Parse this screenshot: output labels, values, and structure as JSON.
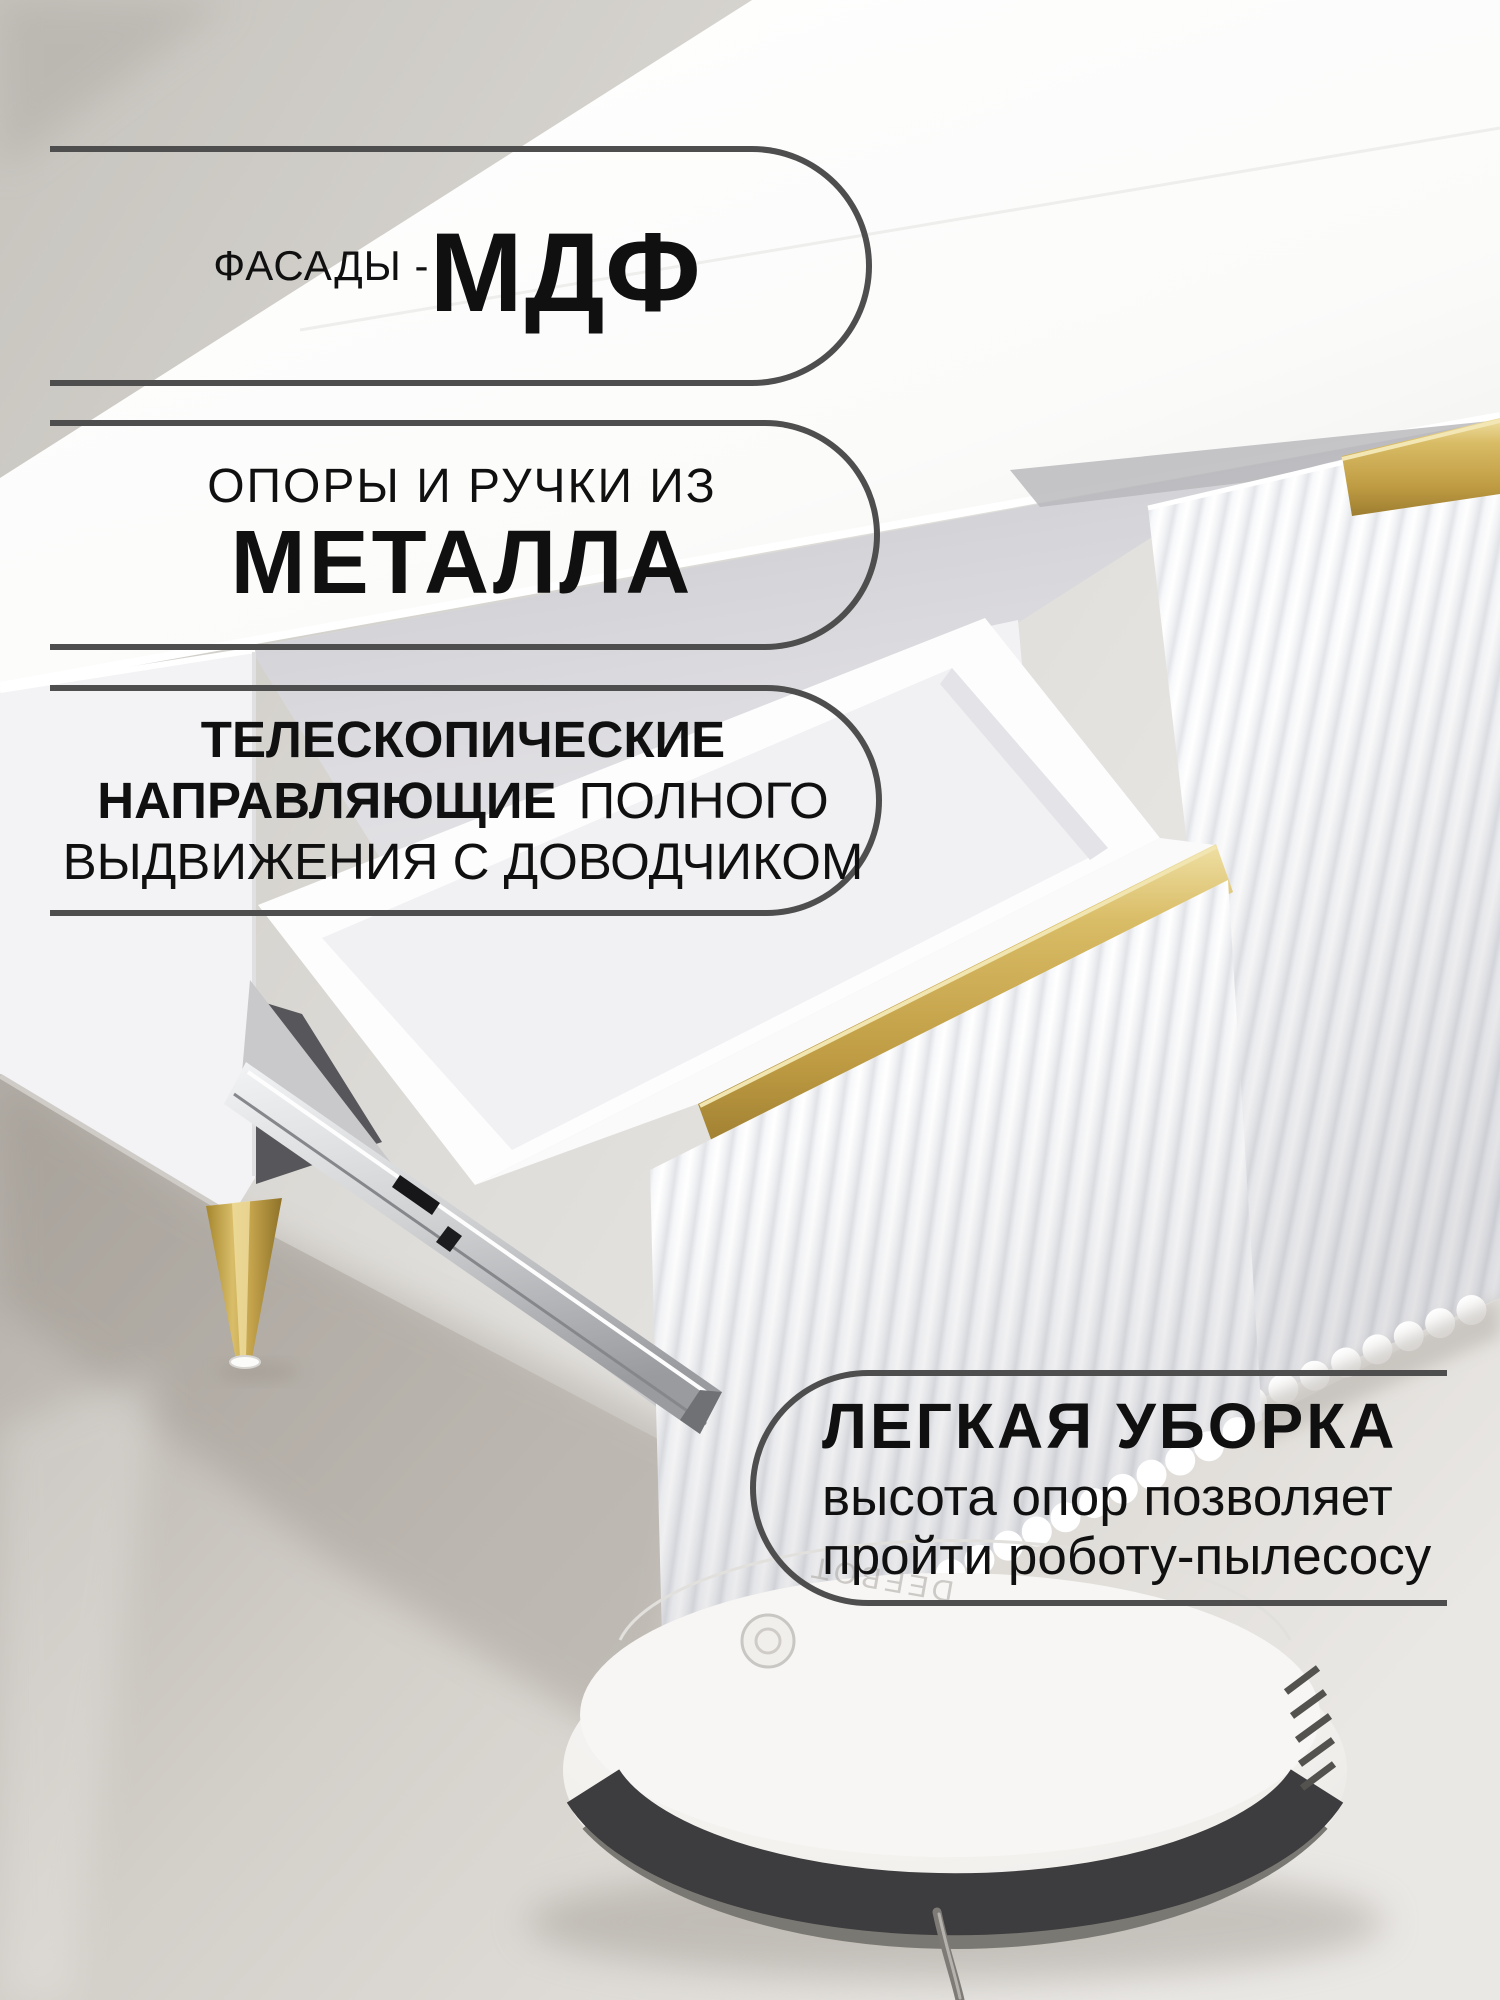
{
  "callouts": [
    {
      "name": "facades",
      "small": "ФАСАДЫ -",
      "big": "МДФ"
    },
    {
      "name": "metal",
      "line1": "ОПОРЫ И РУЧКИ ИЗ",
      "line2": "МЕТАЛЛА"
    },
    {
      "name": "slides",
      "row1": "ТЕЛЕСКОПИЧЕСКИЕ",
      "row2_bold": "НАПРАВЛЯЮЩИЕ",
      "row2_regular": "ПОЛНОГО",
      "row3": "ВЫДВИЖЕНИЯ С ДОВОДЧИКОМ"
    },
    {
      "name": "cleaning",
      "title": "ЛЕГКАЯ УБОРКА",
      "line1": "высота опор позволяет",
      "line2": "пройти роботу-пылесосу"
    }
  ],
  "scene": {
    "robot_logo": "DEEBOT",
    "colors": {
      "callout_border": "#4e4e4e",
      "text": "#101010",
      "gold_handle": "#c9a851",
      "gold_leg": "#bfa04a",
      "robot_bumper": "#3d3c3e",
      "wall": "#c9c6c0",
      "floor": "#cdc9c3"
    }
  }
}
